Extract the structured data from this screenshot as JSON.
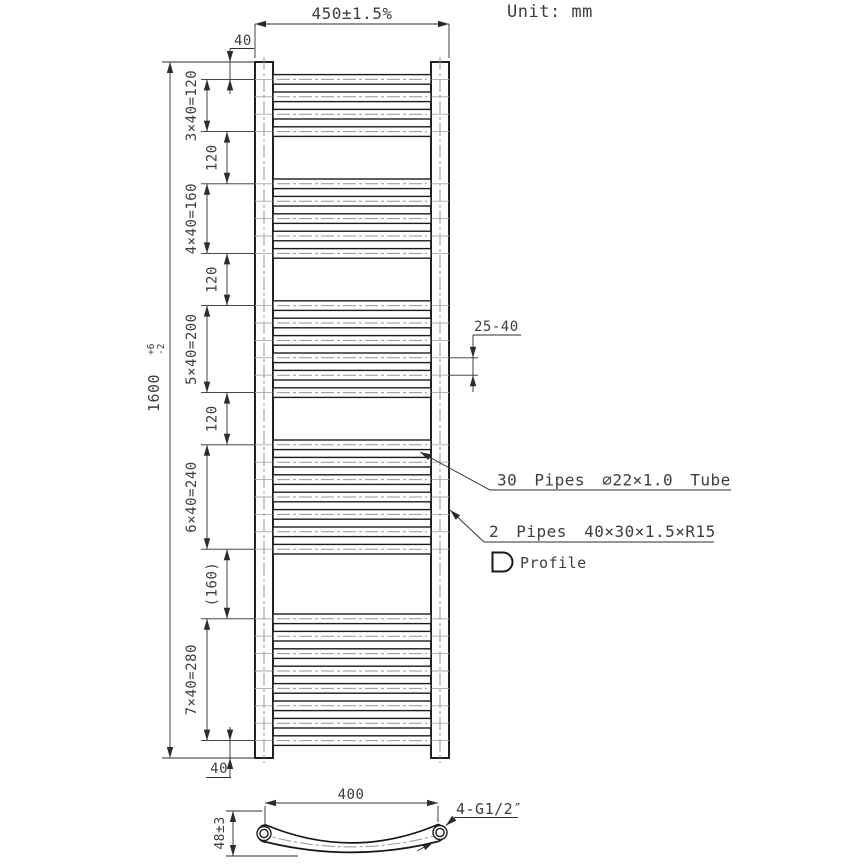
{
  "unit_label": "Unit: mm",
  "main_view": {
    "width_dim": "450±1.5%",
    "tube_width_dim": "40",
    "bottom_offset_dim": "40",
    "height_dim": "1600",
    "height_tol_plus": "+6",
    "height_tol_minus": "-2",
    "pipe_spacing_dim": "25-40",
    "segments": [
      {
        "kind": "offset",
        "mm": 40,
        "label": "40"
      },
      {
        "kind": "group",
        "mm": 120,
        "pipes": 4,
        "label": "3×40=120"
      },
      {
        "kind": "gap",
        "mm": 120,
        "label": "120"
      },
      {
        "kind": "group",
        "mm": 160,
        "pipes": 5,
        "label": "4×40=160"
      },
      {
        "kind": "gap",
        "mm": 120,
        "label": "120"
      },
      {
        "kind": "group",
        "mm": 200,
        "pipes": 6,
        "label": "5×40=200"
      },
      {
        "kind": "gap",
        "mm": 120,
        "label": "120"
      },
      {
        "kind": "group",
        "mm": 240,
        "pipes": 7,
        "label": "6×40=240"
      },
      {
        "kind": "gap",
        "mm": 160,
        "label": "(160)"
      },
      {
        "kind": "group",
        "mm": 280,
        "pipes": 8,
        "label": "7×40=280"
      },
      {
        "kind": "offset",
        "mm": 40,
        "label": "40"
      }
    ],
    "total_pipes_note": "30 Pipes ∅22×1.0 Tube",
    "side_tubes_note": "2 Pipes 40×30×1.5×R15",
    "profile_label": "Profile"
  },
  "bottom_view": {
    "centers_dim": "400",
    "connections_label": "4-G1/2″",
    "depth_dim": "48±3"
  }
}
